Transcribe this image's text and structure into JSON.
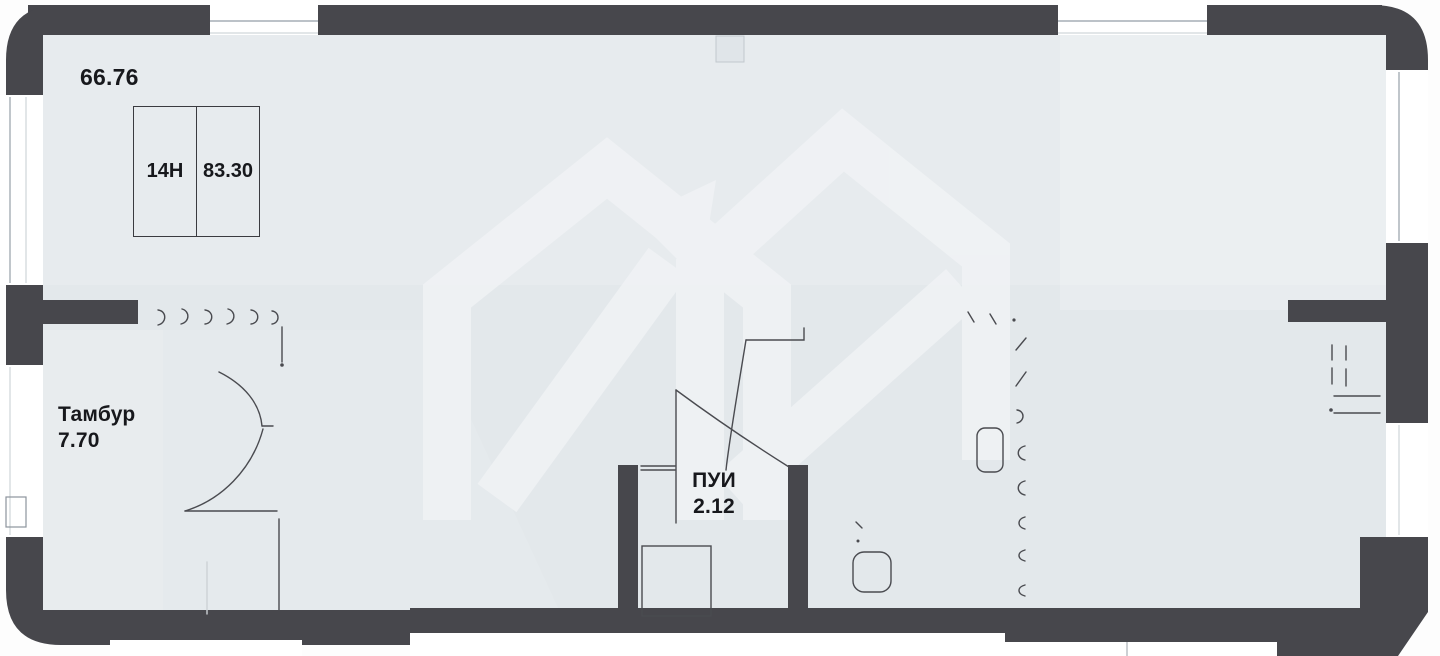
{
  "plan": {
    "title": "floor-plan",
    "total_area": "66.76",
    "unit": {
      "number": "14Н",
      "area": "83.30"
    },
    "rooms": [
      {
        "name": "Тамбур",
        "area": "7.70"
      },
      {
        "name": "ПУИ",
        "area": "2.12"
      }
    ],
    "tambur_label": "Тамбур\n7.70",
    "pui_label": "ПУИ\n2.12"
  },
  "icons": {
    "watermark": "house-arrow-watermark-icon"
  },
  "colors": {
    "wall": "#47474c",
    "floor": "#e3e8eb",
    "window": "#ffffff",
    "glazing_line": "#a6adb5",
    "sketch_line": "#4a4b50",
    "text": "#17181c",
    "watermark": "#f2f4f6"
  }
}
